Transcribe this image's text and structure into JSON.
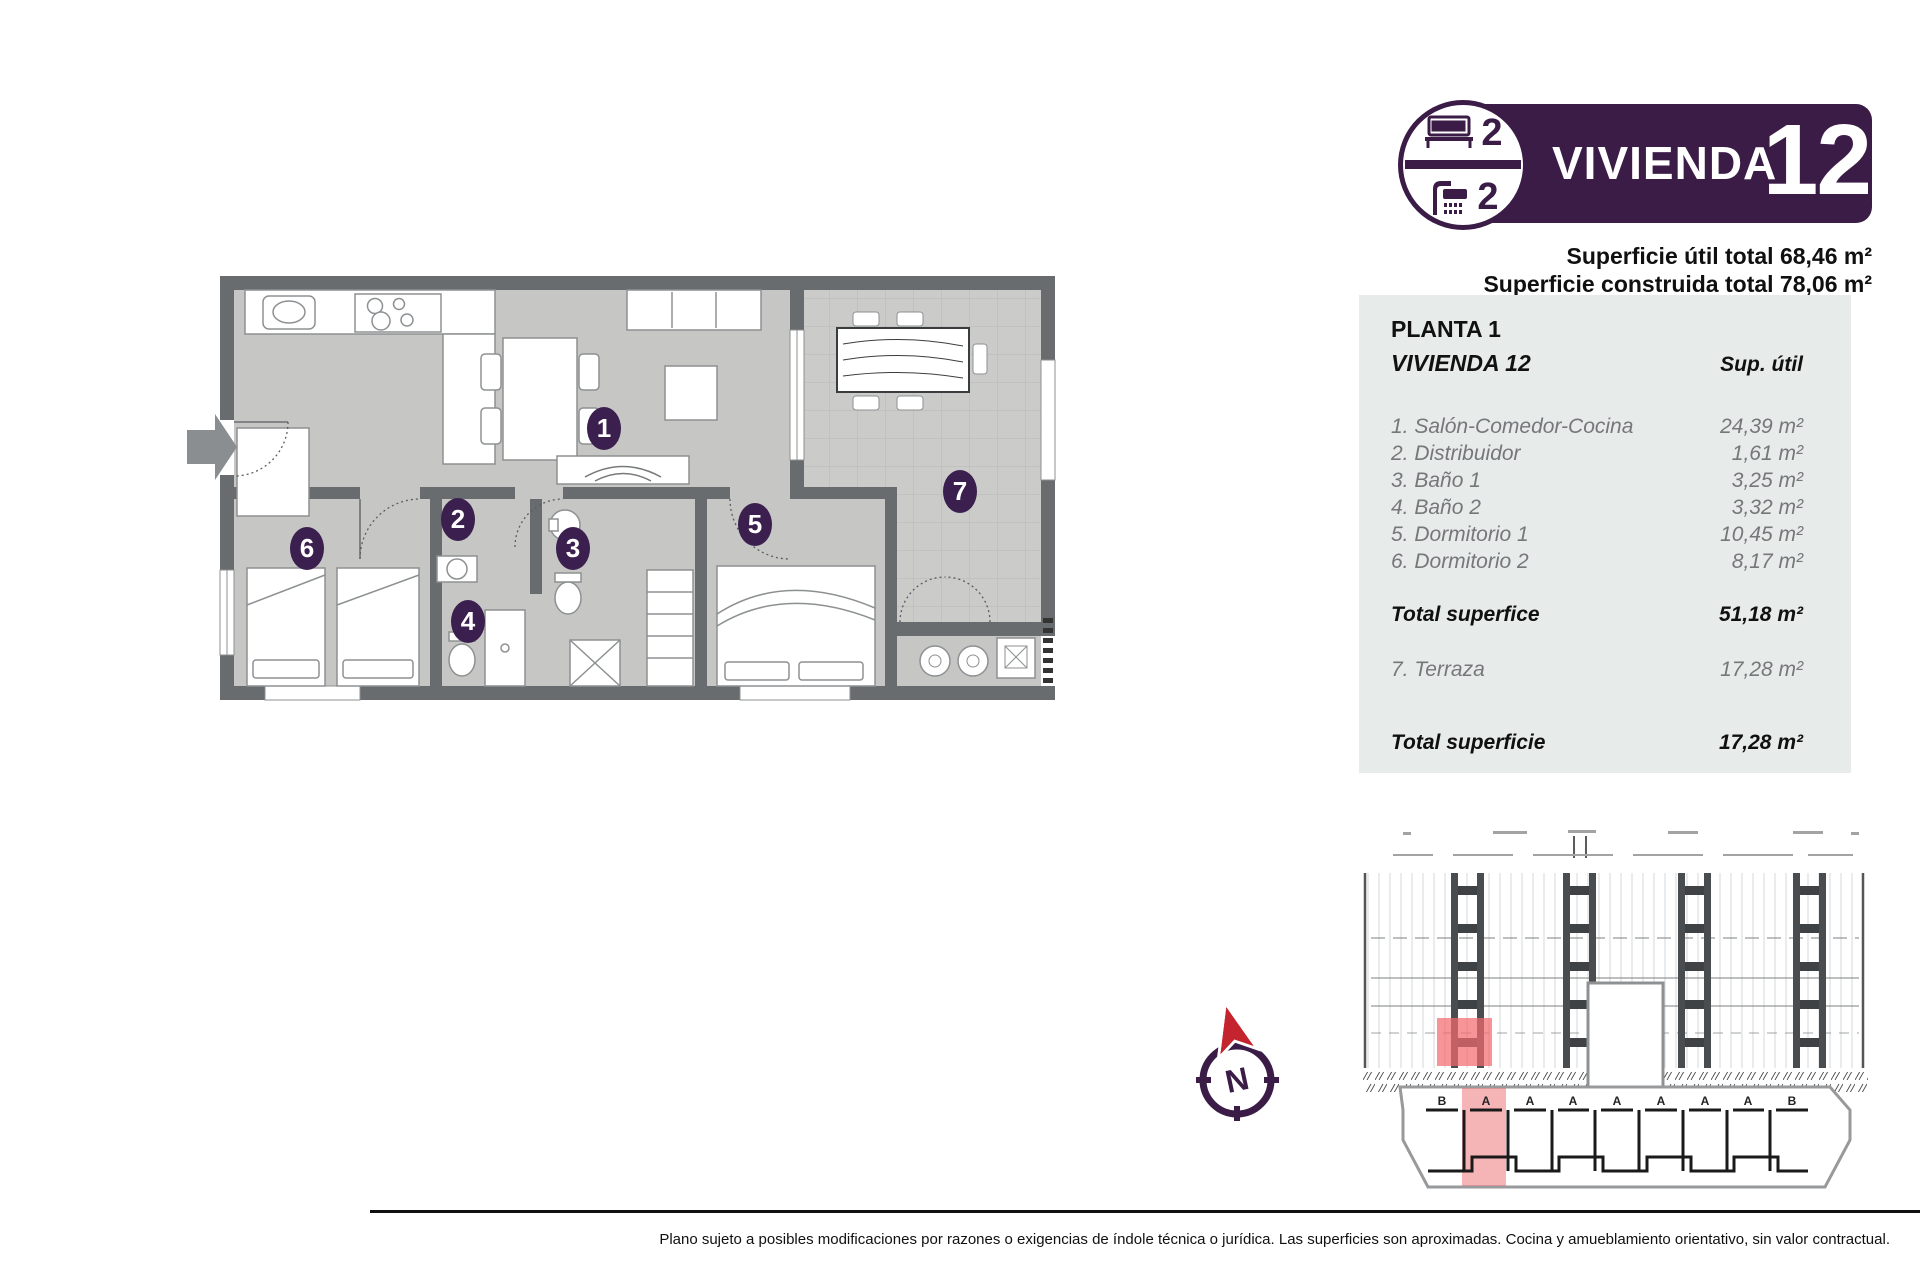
{
  "header": {
    "title": "VIVIENDA",
    "number": "12",
    "bedrooms": "2",
    "bathrooms": "2",
    "superficie_util": "Superficie útil total 68,46 m²",
    "superficie_construida": "Superficie construida total 78,06 m²"
  },
  "table": {
    "floor": "PLANTA 1",
    "unit": "VIVIENDA 12",
    "col_header": "Sup. útil",
    "rows": [
      {
        "label": "1. Salón-Comedor-Cocina",
        "value": "24,39 m²"
      },
      {
        "label": "2. Distribuidor",
        "value": "1,61 m²"
      },
      {
        "label": "3. Baño 1",
        "value": "3,25 m²"
      },
      {
        "label": "4. Baño 2",
        "value": "3,32 m²"
      },
      {
        "label": "5. Dormitorio 1",
        "value": "10,45 m²"
      },
      {
        "label": "6. Dormitorio 2",
        "value": "8,17 m²"
      }
    ],
    "total_interior": {
      "label": "Total superfice",
      "value": "51,18 m²"
    },
    "terraza": {
      "label": "7. Terraza",
      "value": "17,28 m²"
    },
    "total_terraza": {
      "label": "Total superficie",
      "value": "17,28 m²"
    }
  },
  "plan": {
    "rooms": [
      "1",
      "2",
      "3",
      "4",
      "5",
      "6",
      "7"
    ]
  },
  "site_plan": {
    "letters": [
      "B",
      "A",
      "A",
      "A",
      "A",
      "A",
      "A",
      "A",
      "B"
    ]
  },
  "compass": {
    "north": "N"
  },
  "footer": {
    "disclaimer": "Plano sujeto a posibles modificaciones por razones o exigencias de índole técnica o jurídica. Las superficies son aproximadas. Cocina y amueblamiento orientativo, sin valor contractual."
  },
  "colors": {
    "purple": "#3a1c47",
    "badge_purple": "#3b1f4e",
    "red": "#c4242e",
    "highlight_pink": "#f26b6f",
    "panel_bg": "#e7ebea",
    "wall_gray": "#696c6e",
    "floor_gray": "#c6c7c5"
  }
}
